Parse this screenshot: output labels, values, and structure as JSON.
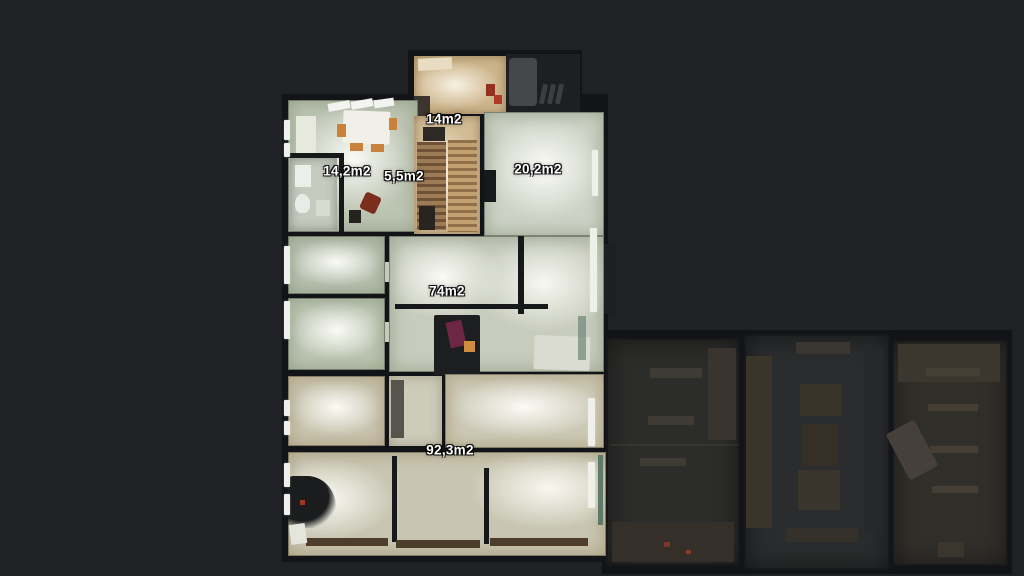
{
  "viewer": {
    "background_color": "#1f2124",
    "wall_color": "#131417",
    "label_color": "#ffffff",
    "floor_lit_color": "#c6cbb9",
    "floor_wood_color": "#cdb58c",
    "annex_floor_color": "#2c2c2b"
  },
  "floorplan": {
    "room_labels": [
      {
        "id": "room-14m2",
        "area": "14m2"
      },
      {
        "id": "room-14-2m2",
        "area": "14,2m2"
      },
      {
        "id": "room-5-5m2",
        "area": "5,5m2"
      },
      {
        "id": "room-20-2m2",
        "area": "20,2m2"
      },
      {
        "id": "room-74m2",
        "area": "74m2"
      },
      {
        "id": "room-92-3m2",
        "area": "92,3m2"
      }
    ]
  }
}
